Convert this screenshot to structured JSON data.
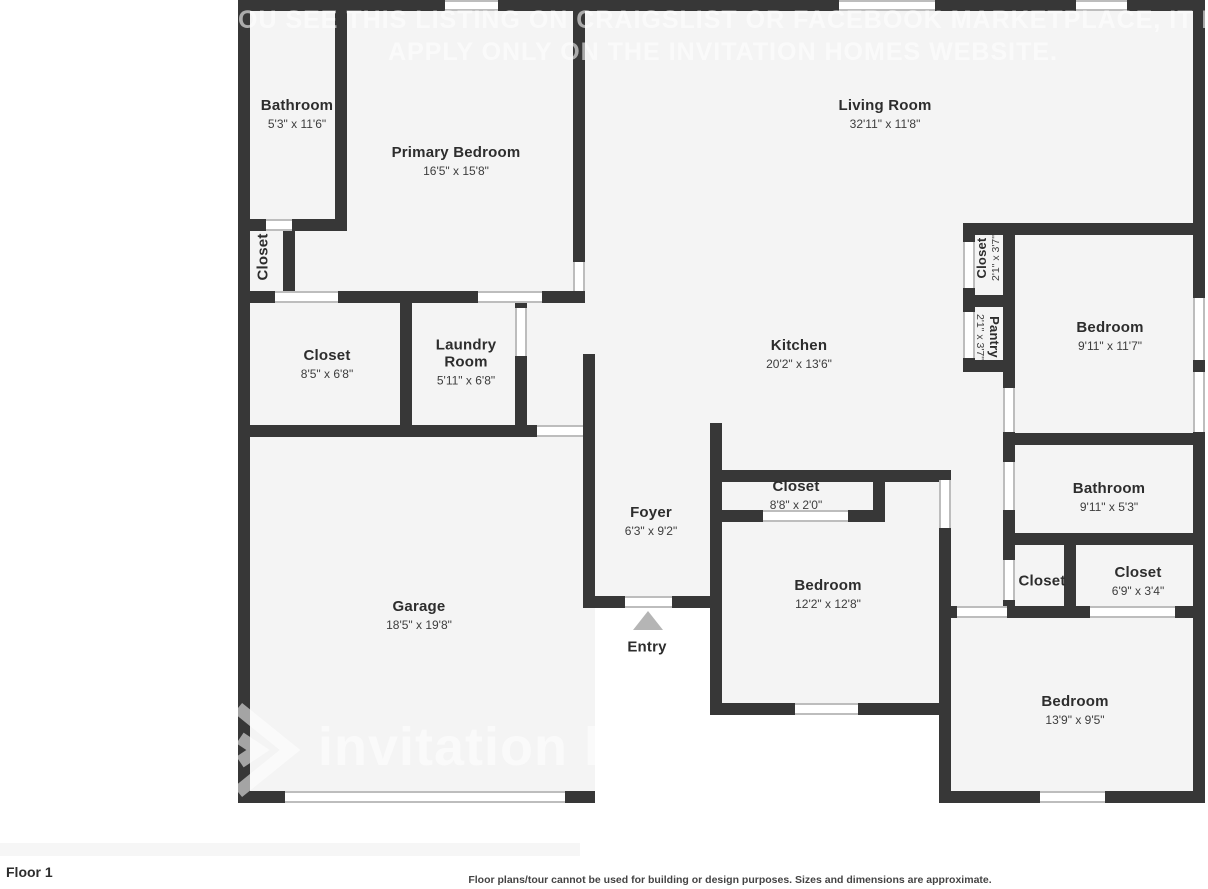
{
  "watermark": {
    "line1": "OU SEE THIS LISTING ON CRAIGSLIST OR FACEBOOK MARKETPLACE, IT IS FRA",
    "line2": "APPLY ONLY ON THE INVITATION HOMES WEBSITE.",
    "brand": "invitation ho"
  },
  "rooms": {
    "bathroom_primary": {
      "name": "Bathroom",
      "dims": "5'3\" x 11'6\""
    },
    "primary_bedroom": {
      "name": "Primary Bedroom",
      "dims": "16'5\" x 15'8\""
    },
    "living_room": {
      "name": "Living Room",
      "dims": "32'11\" x 11'8\""
    },
    "closet_hall_left": {
      "name": "Closet"
    },
    "closet_main": {
      "name": "Closet",
      "dims": "8'5\" x 6'8\""
    },
    "laundry_room": {
      "name": "Laundry Room",
      "dims": "5'11\" x 6'8\""
    },
    "kitchen": {
      "name": "Kitchen",
      "dims": "20'2\" x 13'6\""
    },
    "closet_right": {
      "name": "Closet",
      "dims": "2'1\" x 3'7\""
    },
    "pantry": {
      "name": "Pantry",
      "dims": "2'1\" x 3'7\""
    },
    "bedroom_ne": {
      "name": "Bedroom",
      "dims": "9'11\" x 11'7\""
    },
    "bathroom_east": {
      "name": "Bathroom",
      "dims": "9'11\" x 5'3\""
    },
    "closet_hall_east": {
      "name": "Closet"
    },
    "closet_east": {
      "name": "Closet",
      "dims": "6'9\" x 3'4\""
    },
    "foyer": {
      "name": "Foyer",
      "dims": "6'3\" x 9'2\""
    },
    "closet_bedroom_south": {
      "name": "Closet",
      "dims": "8'8\" x 2'0\""
    },
    "bedroom_south": {
      "name": "Bedroom",
      "dims": "12'2\" x 12'8\""
    },
    "garage": {
      "name": "Garage",
      "dims": "18'5\" x 19'8\""
    },
    "entry": {
      "name": "Entry"
    },
    "bedroom_se": {
      "name": "Bedroom",
      "dims": "13'9\" x 9'5\""
    }
  },
  "footer": {
    "floor_label": "Floor 1",
    "disclaimer": "Floor plans/tour cannot be used for building or design purposes. Sizes and dimensions are approximate."
  },
  "colors": {
    "wall": "#373737",
    "room_fill": "#f4f4f4",
    "entry_arrow": "#b5b5b5"
  }
}
